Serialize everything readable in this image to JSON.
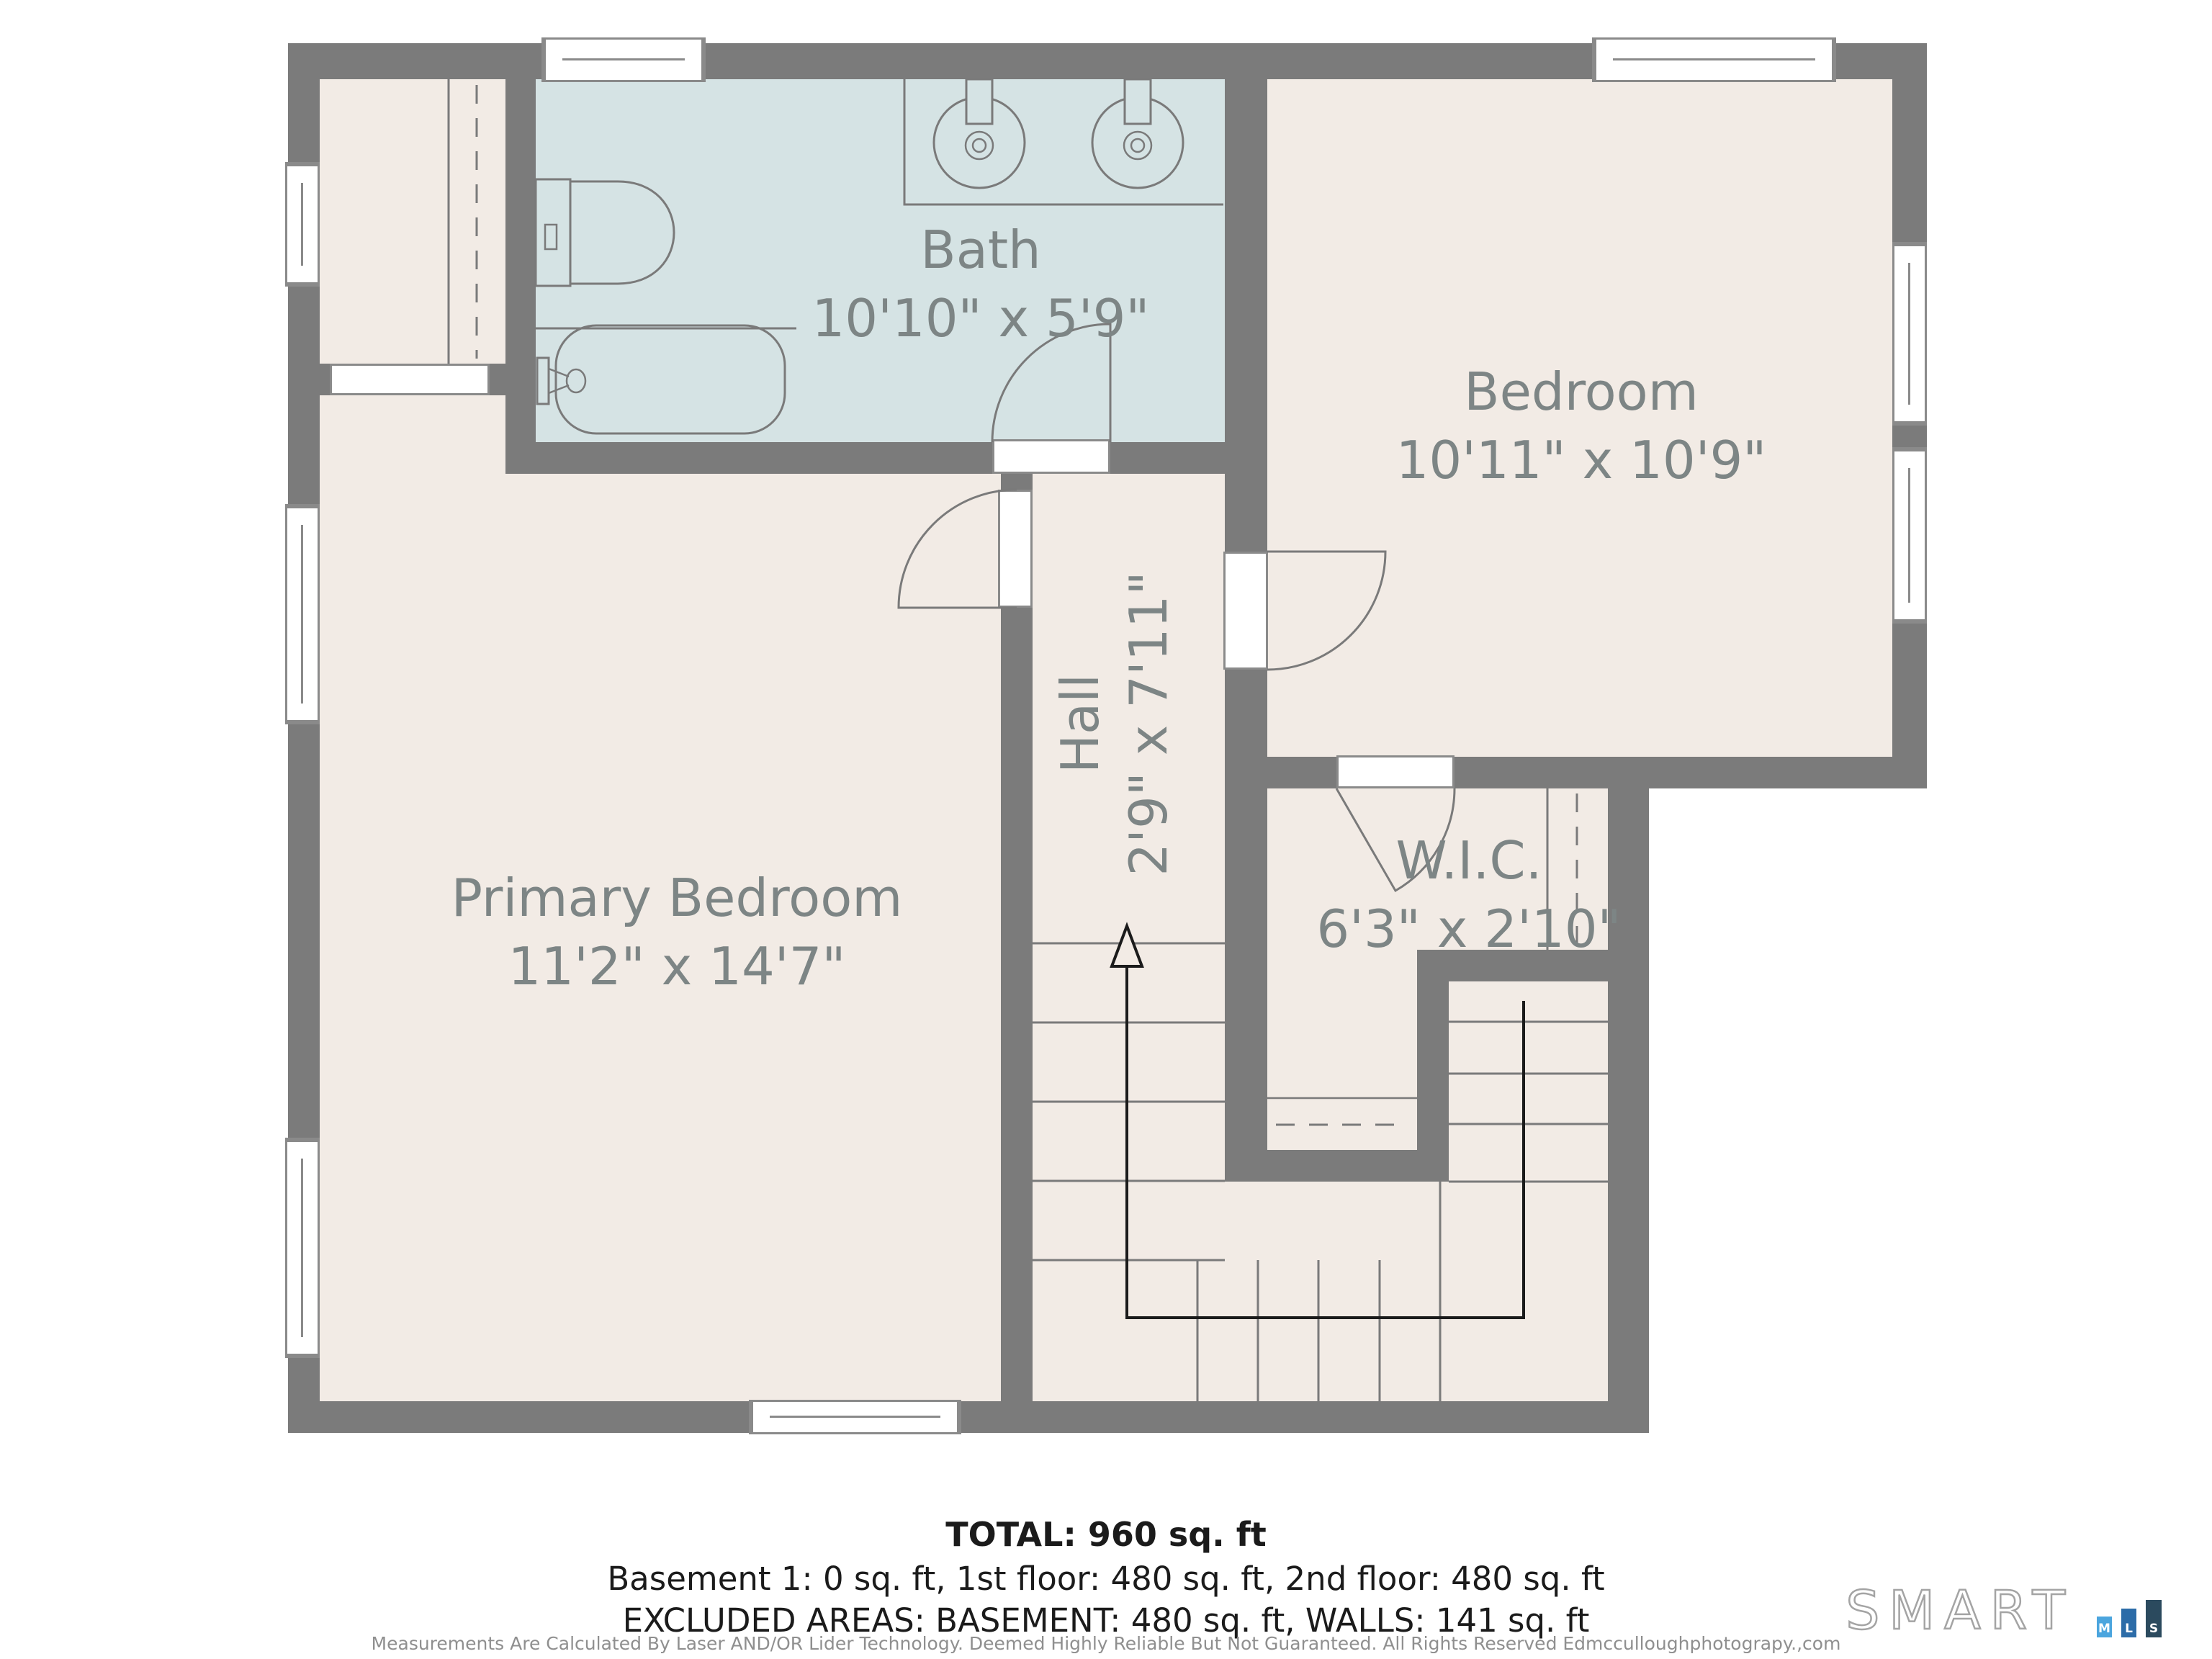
{
  "rooms": [
    {
      "id": "bath",
      "name": "Bath",
      "dims": "10'10\" x 5'9\""
    },
    {
      "id": "bedroom",
      "name": "Bedroom",
      "dims": "10'11\" x 10'9\""
    },
    {
      "id": "primary",
      "name": "Primary Bedroom",
      "dims": "11'2\" x 14'7\""
    },
    {
      "id": "hall",
      "name": "Hall",
      "dims": "2'9\" x 7'11\""
    },
    {
      "id": "wic",
      "name": "W.I.C.",
      "dims": "6'3\" x 2'10\""
    }
  ],
  "summary": {
    "total": "TOTAL: 960 sq. ft",
    "floors": "Basement 1: 0 sq. ft, 1st floor: 480 sq. ft, 2nd floor: 480 sq. ft",
    "excluded": "EXCLUDED AREAS: BASEMENT: 480 sq. ft, WALLS: 141 sq. ft"
  },
  "disclaimer": "Measurements Are Calculated By Laser AND/OR Lider Technology. Deemed Highly Reliable But Not Guaranteed. All Rights Reserved Edmcculloughphotograpy.,com",
  "logo": {
    "text": "SMART",
    "bars": [
      {
        "letter": "M",
        "color": "#4BA5DE"
      },
      {
        "letter": "L",
        "color": "#2C6CA8"
      },
      {
        "letter": "S",
        "color": "#2B4A5E"
      }
    ]
  },
  "colors": {
    "wall": "#7b7b7b",
    "floor": "#f2ebe5",
    "bath": "#d5e3e4",
    "line": "#7a7a7a",
    "label": "#7d8585",
    "ink": "#1b1b1b",
    "muted": "#8f8f8f",
    "window": "#ffffff"
  }
}
